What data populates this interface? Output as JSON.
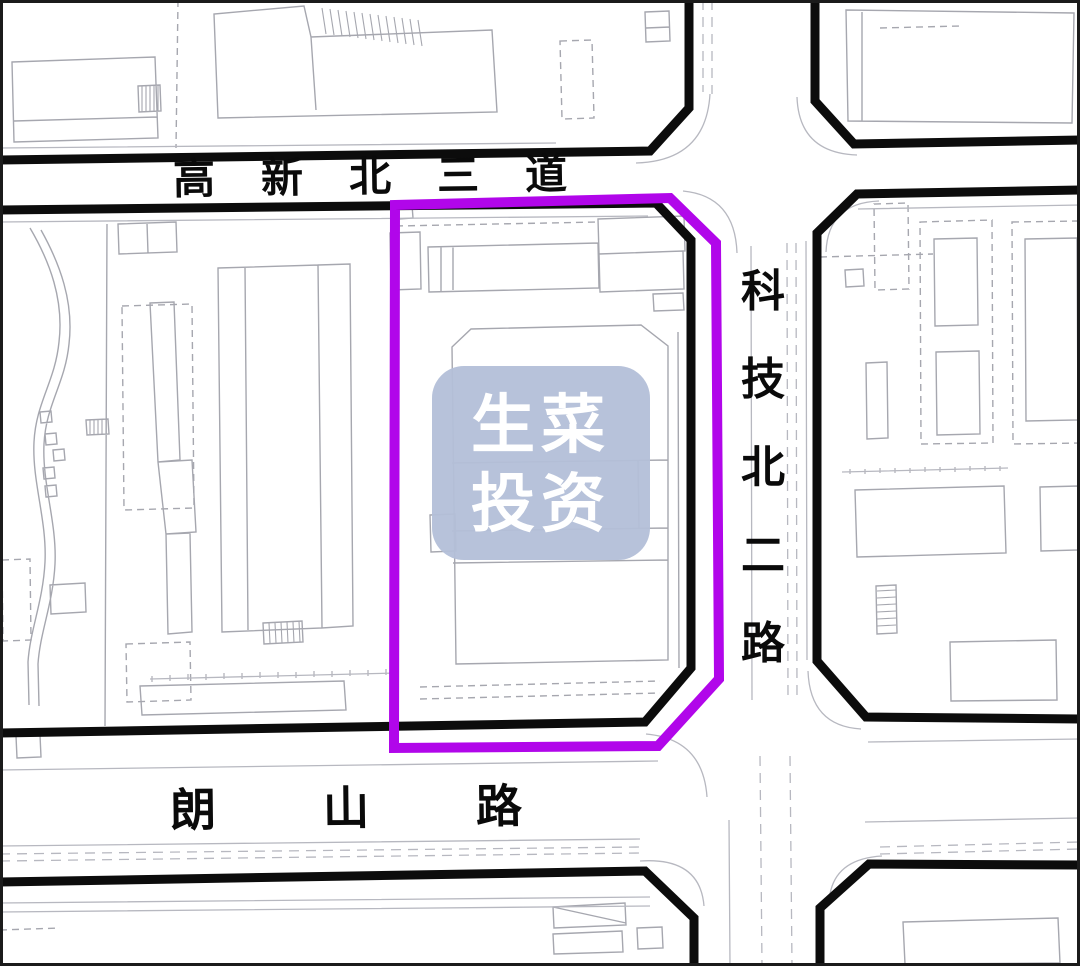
{
  "roads": {
    "top": {
      "label": "高新北三道"
    },
    "right": {
      "label": "科技北二路"
    },
    "bottom": {
      "label": "朗山路"
    }
  },
  "watermark": {
    "line1": "生菜",
    "line2": "投资"
  },
  "colors": {
    "parcel_boundary": "#b106ea",
    "road_edge": "#0c0c0c",
    "building_line": "#a6a7af",
    "curb_line": "#b7b8c0",
    "watermark_bg": "#b3bfd8",
    "watermark_text": "#ffffff",
    "map_background": "#ffffff",
    "map_border": "#1b1b1b"
  }
}
